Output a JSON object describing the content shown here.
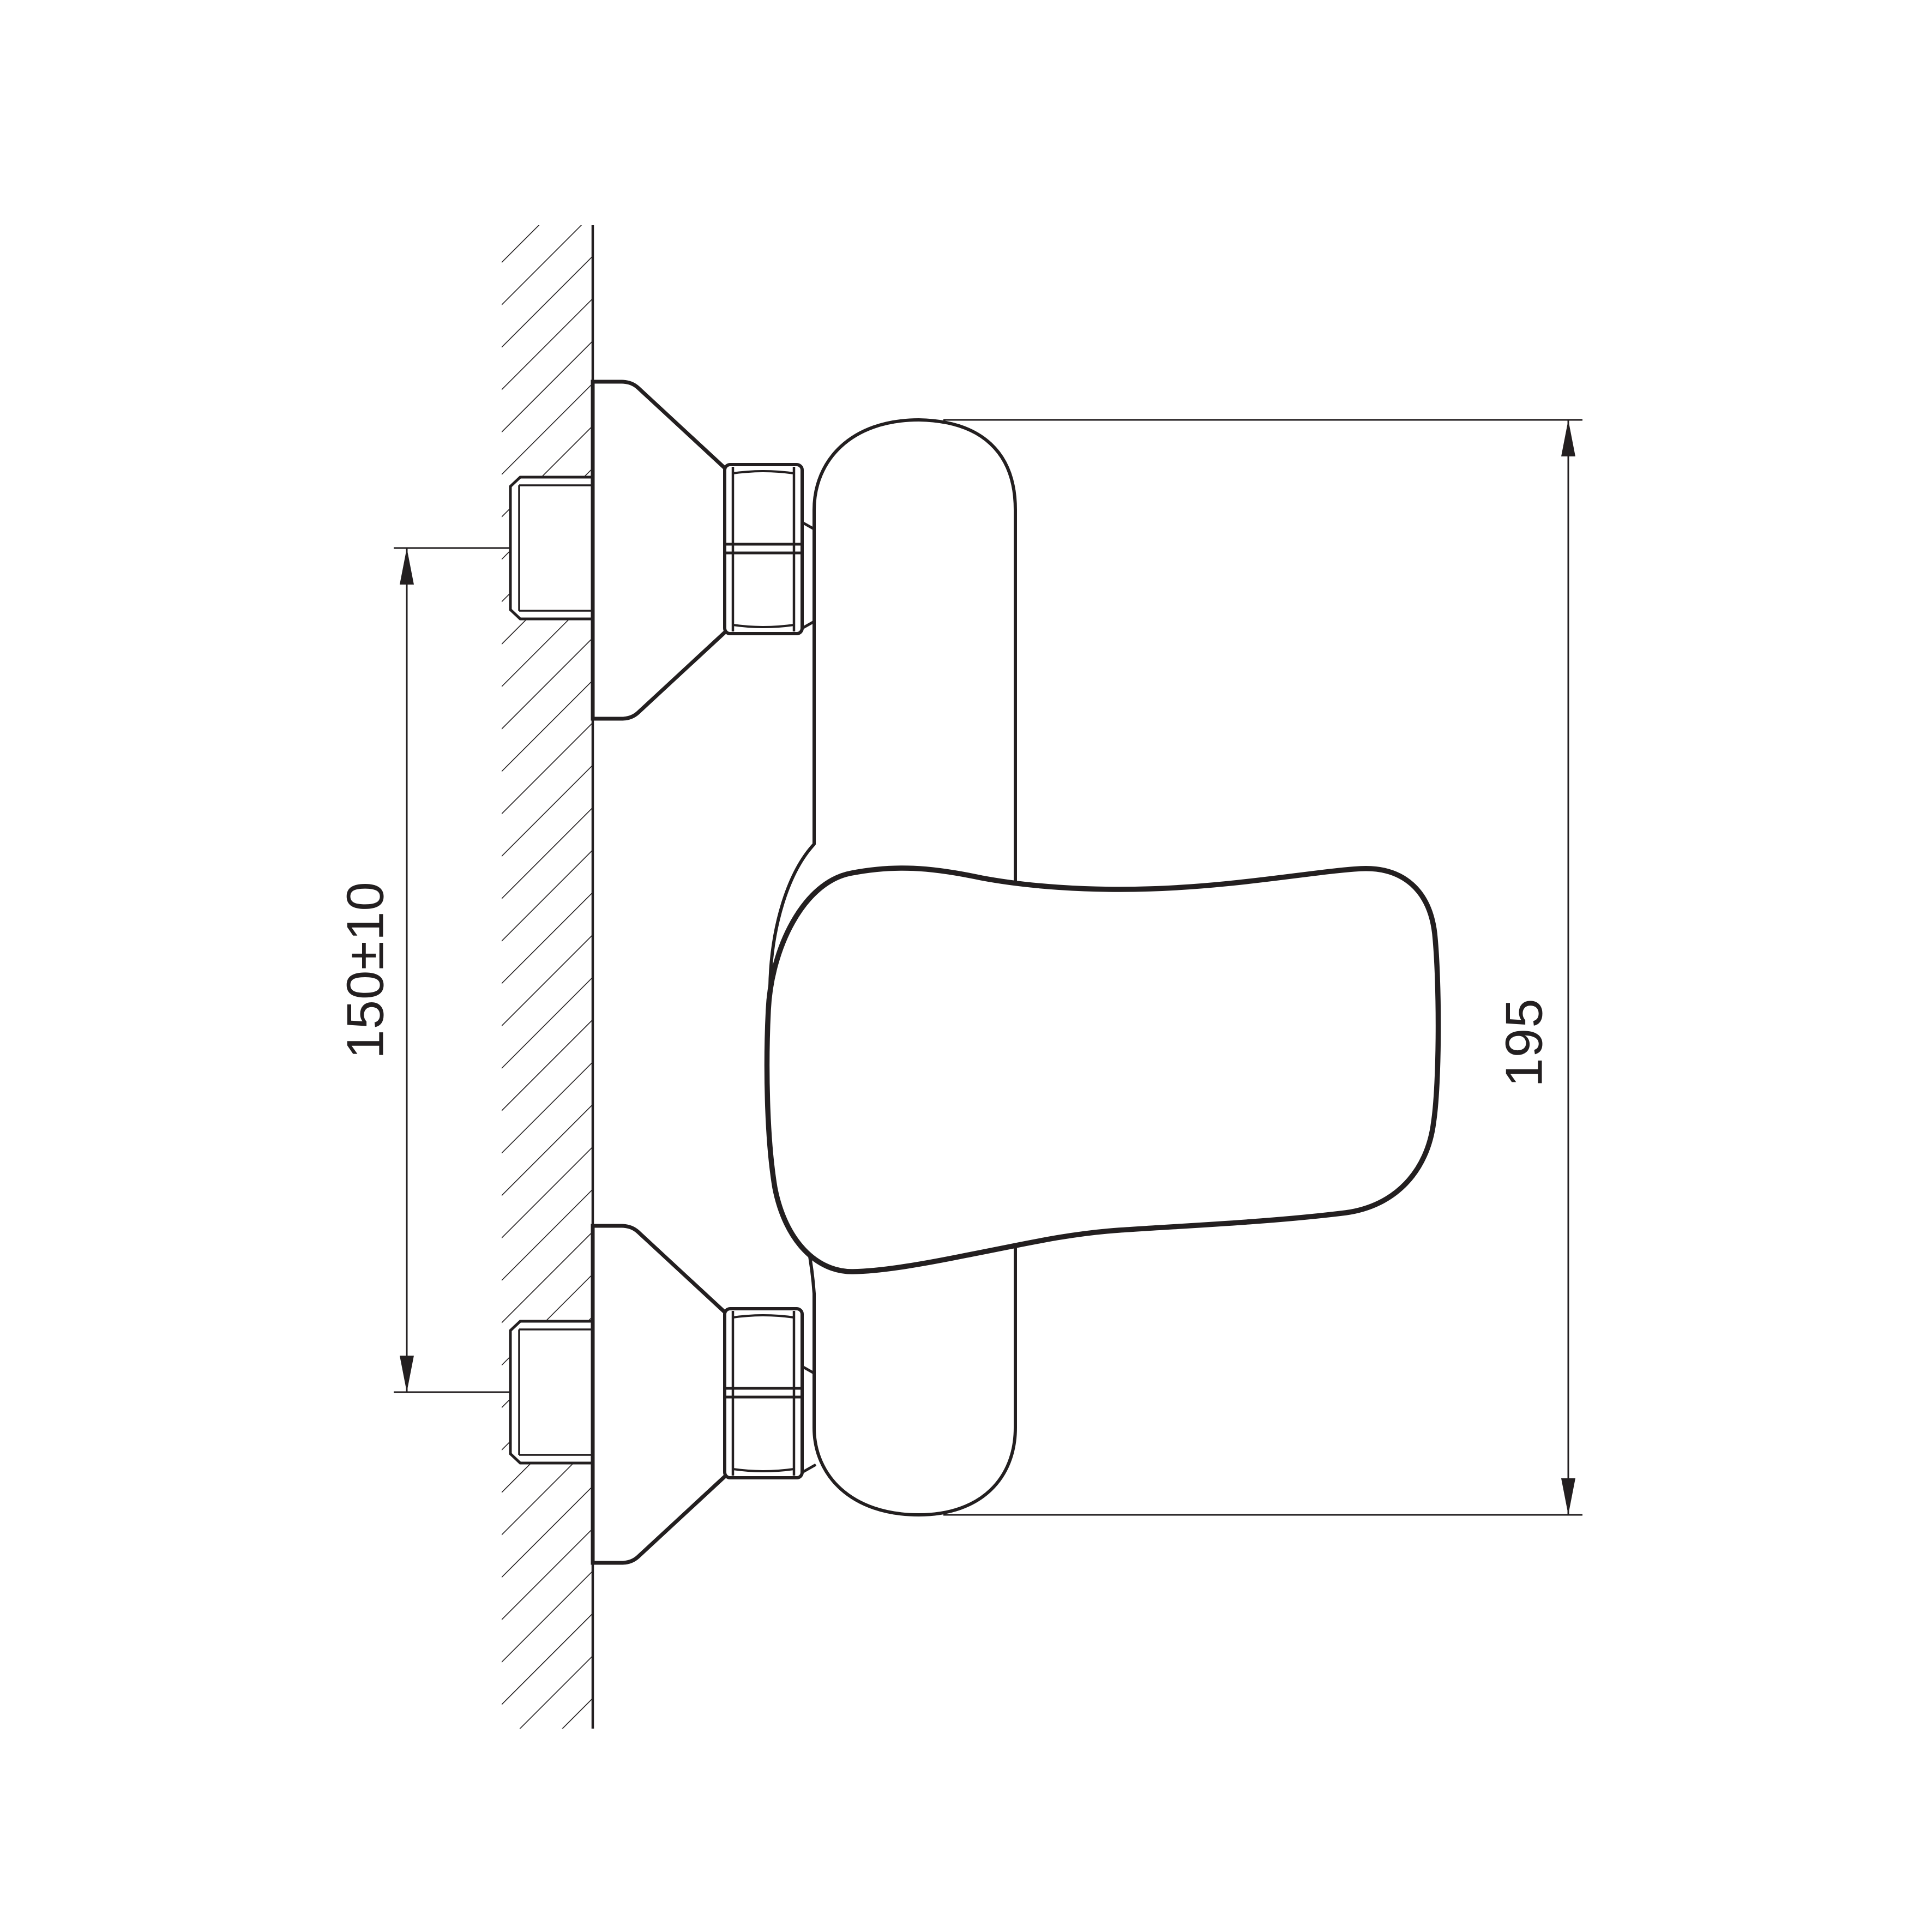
{
  "drawing": {
    "type": "technical-installation-diagram",
    "subject": "wall-mounted-single-lever-mixer-side-view",
    "dimensions": {
      "pipe_spacing": {
        "label": "150±10",
        "orientation": "vertical"
      },
      "overall_height": {
        "label": "195",
        "orientation": "vertical"
      }
    },
    "colors": {
      "line": "#231f20",
      "background": "#ffffff"
    }
  }
}
